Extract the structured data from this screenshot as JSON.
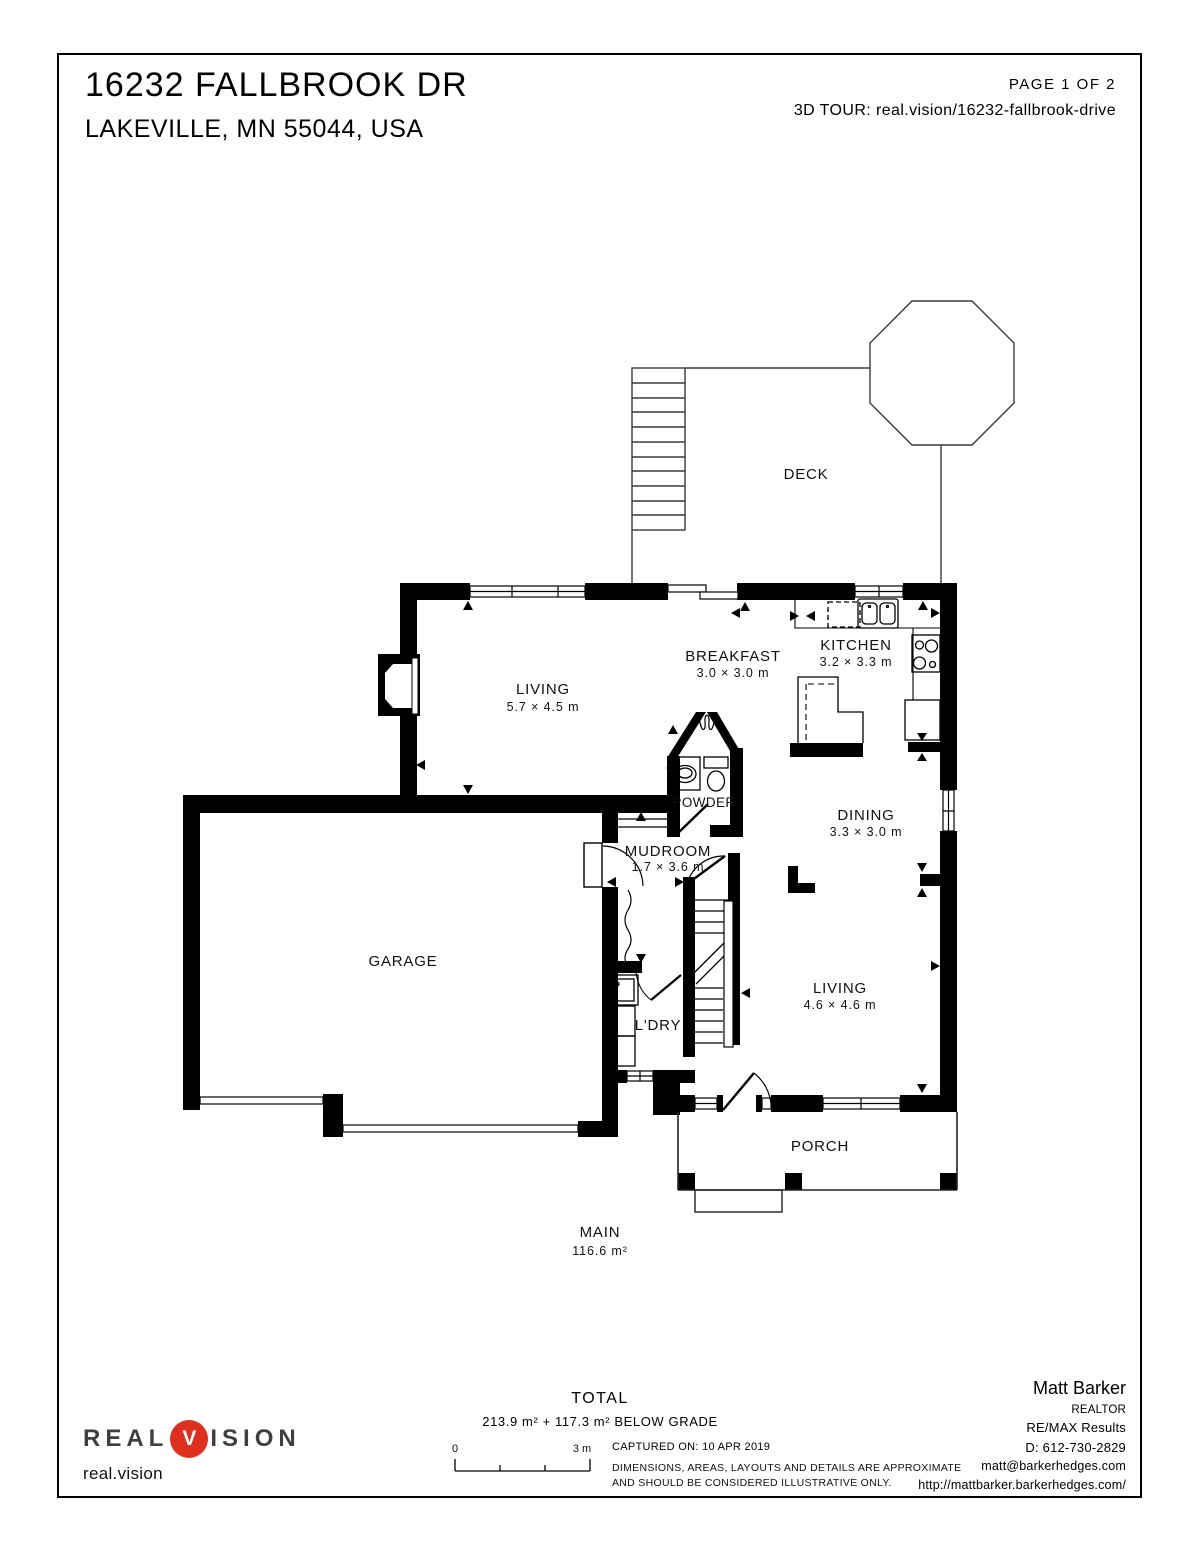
{
  "header": {
    "title": "16232 FALLBROOK DR",
    "subtitle": "LAKEVILLE, MN 55044, USA",
    "page_label": "PAGE 1 OF 2",
    "tour_label": "3D TOUR:",
    "tour_link": "real.vision/16232-fallbrook-drive"
  },
  "rooms": {
    "deck": {
      "name": "DECK"
    },
    "living_main": {
      "name": "LIVING",
      "dims": "5.7 × 4.5 m"
    },
    "breakfast": {
      "name": "BREAKFAST",
      "dims": "3.0 × 3.0 m"
    },
    "kitchen": {
      "name": "KITCHEN",
      "dims": "3.2 × 3.3 m"
    },
    "powder": {
      "name": "POWDER"
    },
    "dining": {
      "name": "DINING",
      "dims": "3.3 × 3.0 m"
    },
    "mudroom": {
      "name": "MUDROOM",
      "dims": "1.7 × 3.6 m"
    },
    "garage": {
      "name": "GARAGE"
    },
    "laundry": {
      "name": "L'DRY"
    },
    "living_family": {
      "name": "LIVING",
      "dims": "4.6 × 4.6 m"
    },
    "porch": {
      "name": "PORCH"
    },
    "floor": {
      "name": "MAIN",
      "area": "116.6 m²"
    }
  },
  "footer": {
    "total_label": "TOTAL",
    "total_value": "213.9 m² + 117.3 m² BELOW GRADE",
    "scale": {
      "start": "0",
      "end": "3 m"
    },
    "captured": "CAPTURED ON: 10 APR 2019",
    "disclaimer_1": "DIMENSIONS, AREAS, LAYOUTS AND DETAILS ARE APPROXIMATE",
    "disclaimer_2": "AND SHOULD BE CONSIDERED ILLUSTRATIVE ONLY.",
    "agent": {
      "name": "Matt Barker",
      "title": "REALTOR",
      "company": "RE/MAX Results",
      "phone": "D: 612-730-2829",
      "email": "matt@barkerhedges.com",
      "website": "http://mattbarker.barkerhedges.com/"
    },
    "logo": {
      "left": "REAL",
      "v": "V",
      "right": "ISION",
      "domain": "real.vision"
    }
  },
  "colors": {
    "logo_red": "#df2f1f",
    "line_black": "#000000"
  }
}
